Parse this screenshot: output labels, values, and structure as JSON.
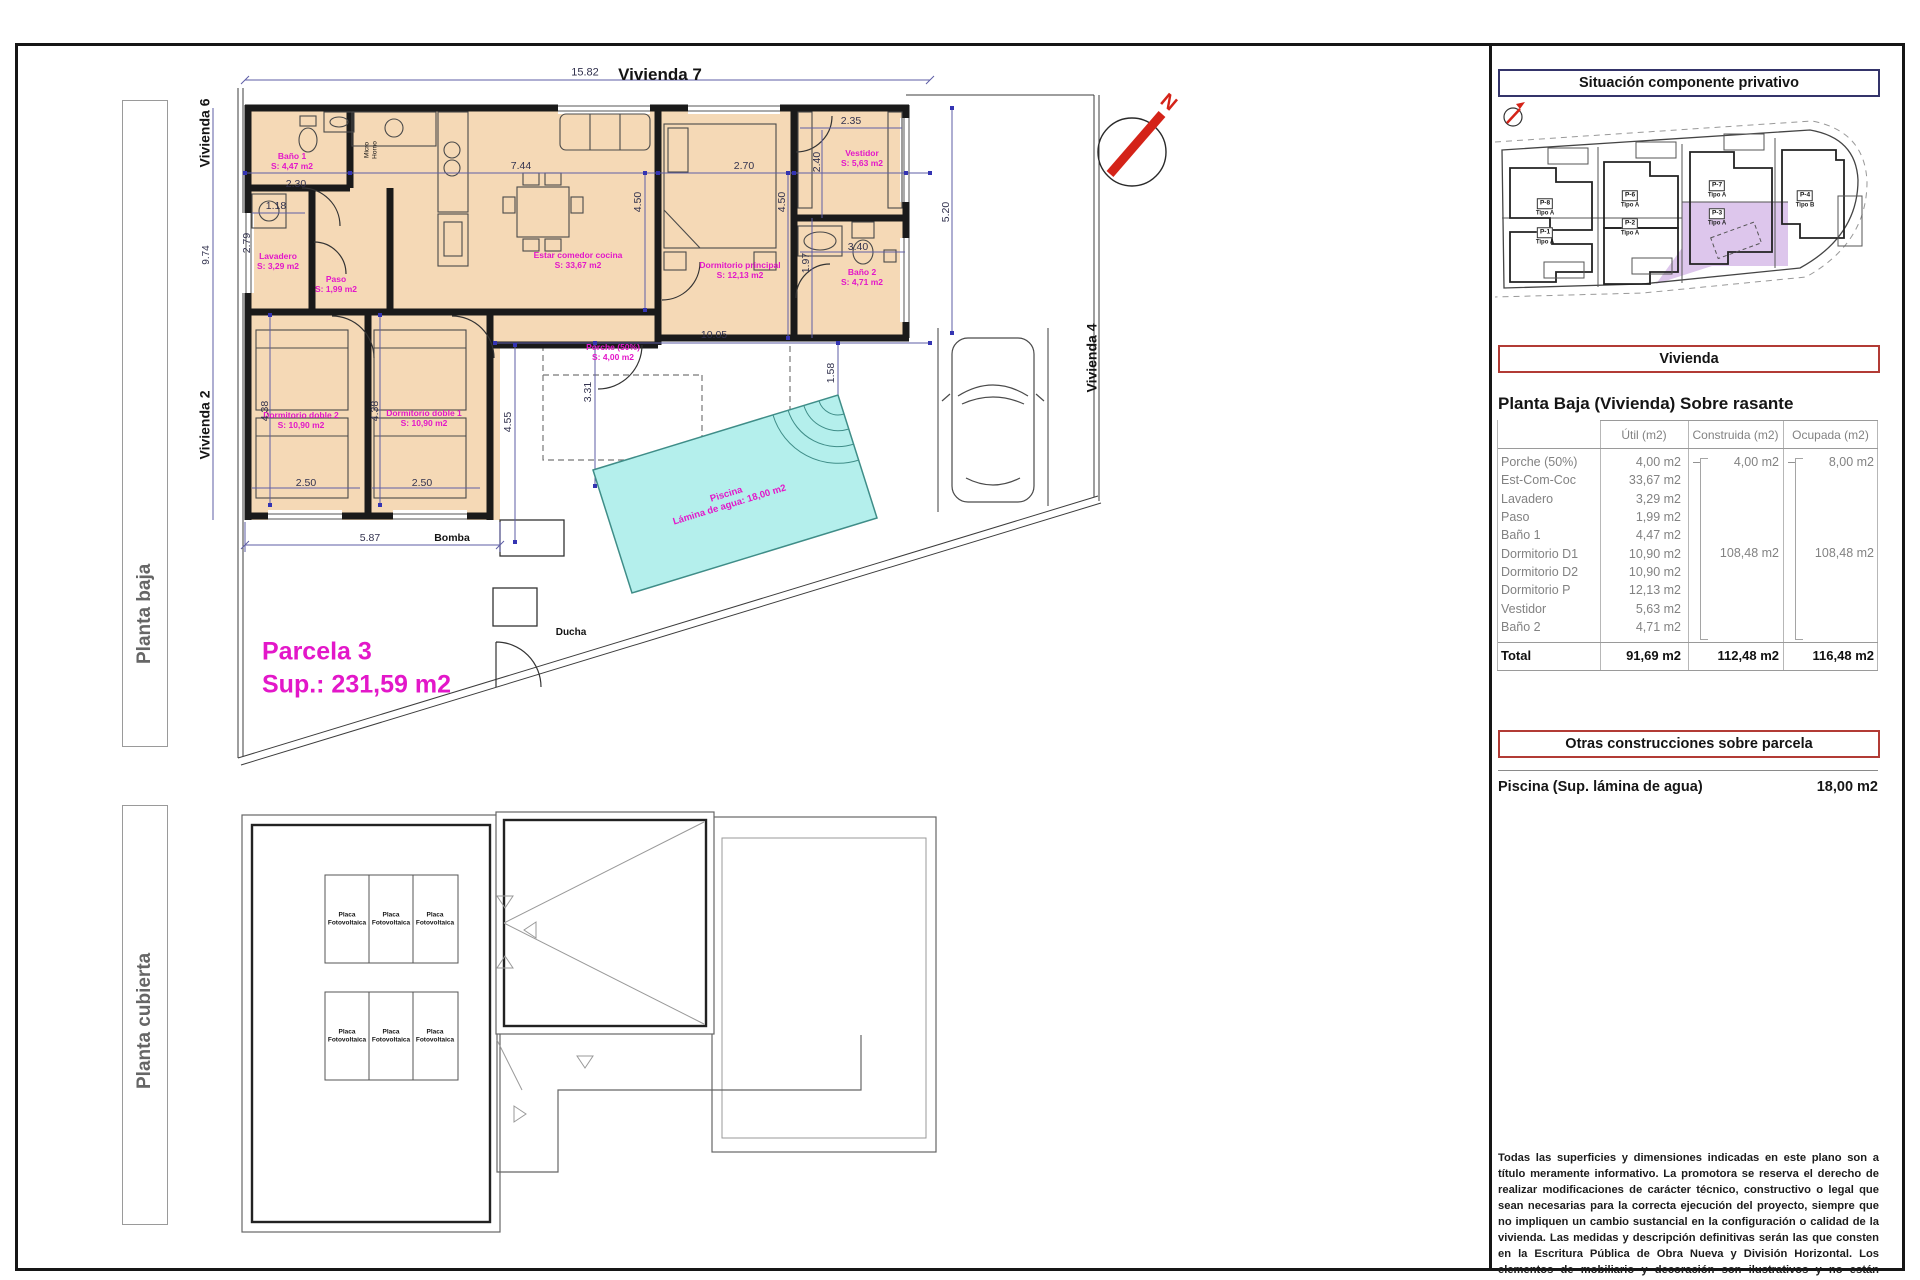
{
  "colors": {
    "ink": "#141414",
    "magenta": "#e317c9",
    "dim": "#32324e",
    "red": "#d42318",
    "gray": "#828282",
    "wall": "#1a1a1a",
    "floor_fill": "#f5d9b6",
    "pool_fill": "#b4efec",
    "lavender": "#ddc6ec",
    "accent_red_border": "#b23b35",
    "accent_navy_border": "#34346a"
  },
  "side_labels": {
    "planta_baja": "Planta baja",
    "planta_cubierta": "Planta cubierta"
  },
  "floor_plan": {
    "labels": [
      {
        "t": "15.82",
        "x": 585,
        "y": 73,
        "s": 11,
        "c": "dim"
      },
      {
        "t": "Vivienda 7",
        "x": 660,
        "y": 75,
        "s": 17,
        "c": "ink",
        "b": 1
      },
      {
        "t": "Vivienda 6",
        "x": 205,
        "y": 133,
        "s": 14,
        "c": "ink",
        "b": 1,
        "r": -90
      },
      {
        "t": "Vivienda 2",
        "x": 205,
        "y": 425,
        "s": 14,
        "c": "ink",
        "b": 1,
        "r": -90
      },
      {
        "t": "Vivienda 4",
        "x": 1092,
        "y": 358,
        "s": 14,
        "c": "ink",
        "b": 1,
        "r": -90
      },
      {
        "t": "9.74",
        "x": 207,
        "y": 255,
        "s": 10,
        "c": "dim",
        "r": -90
      },
      {
        "t": "Baño 1\nS: 4,47 m2",
        "x": 292,
        "y": 161,
        "s": 8.5,
        "c": "magenta",
        "b": 1
      },
      {
        "t": "2.30",
        "x": 296,
        "y": 184,
        "s": 10.5,
        "c": "dim"
      },
      {
        "t": "1.18",
        "x": 276,
        "y": 206,
        "s": 10.5,
        "c": "dim"
      },
      {
        "t": "2.79",
        "x": 247,
        "y": 243,
        "s": 10.5,
        "c": "dim",
        "r": -90
      },
      {
        "t": "Lavadero\nS: 3,29 m2",
        "x": 278,
        "y": 261,
        "s": 8.5,
        "c": "magenta",
        "b": 1
      },
      {
        "t": "Paso\nS: 1,99 m2",
        "x": 336,
        "y": 284,
        "s": 8.5,
        "c": "magenta",
        "b": 1
      },
      {
        "t": "Micro\nHorno",
        "x": 371,
        "y": 150,
        "s": 6.5,
        "c": "ink",
        "r": -90
      },
      {
        "t": "7.44",
        "x": 521,
        "y": 166,
        "s": 10.5,
        "c": "dim"
      },
      {
        "t": "4.50",
        "x": 638,
        "y": 202,
        "s": 10.5,
        "c": "dim",
        "r": -90
      },
      {
        "t": "Estar comedor cocina\nS: 33,67 m2",
        "x": 578,
        "y": 260,
        "s": 8.5,
        "c": "magenta",
        "b": 1
      },
      {
        "t": "2.70",
        "x": 744,
        "y": 166,
        "s": 10.5,
        "c": "dim"
      },
      {
        "t": "4.50",
        "x": 782,
        "y": 202,
        "s": 10.5,
        "c": "dim",
        "r": -90
      },
      {
        "t": "Dormitorio principal\nS: 12,13 m2",
        "x": 740,
        "y": 270,
        "s": 8.5,
        "c": "magenta",
        "b": 1
      },
      {
        "t": "2.35",
        "x": 851,
        "y": 121,
        "s": 10.5,
        "c": "dim"
      },
      {
        "t": "2.40",
        "x": 817,
        "y": 162,
        "s": 10.5,
        "c": "dim",
        "r": -90
      },
      {
        "t": "Vestidor\nS: 5,63 m2",
        "x": 862,
        "y": 158,
        "s": 8.5,
        "c": "magenta",
        "b": 1
      },
      {
        "t": "3.40",
        "x": 858,
        "y": 247,
        "s": 10.5,
        "c": "dim"
      },
      {
        "t": "1.97",
        "x": 806,
        "y": 263,
        "s": 10.5,
        "c": "dim",
        "r": -90
      },
      {
        "t": "Baño 2\nS: 4,71 m2",
        "x": 862,
        "y": 277,
        "s": 8.5,
        "c": "magenta",
        "b": 1
      },
      {
        "t": "5.20",
        "x": 946,
        "y": 212,
        "s": 10.5,
        "c": "dim",
        "r": -90
      },
      {
        "t": "10.05",
        "x": 714,
        "y": 335,
        "s": 10.5,
        "c": "dim"
      },
      {
        "t": "1.58",
        "x": 831,
        "y": 373,
        "s": 10.5,
        "c": "dim",
        "r": -90
      },
      {
        "t": "Porche (50%)\nS: 4,00 m2",
        "x": 613,
        "y": 352,
        "s": 8.5,
        "c": "magenta",
        "b": 1
      },
      {
        "t": "4.55",
        "x": 508,
        "y": 422,
        "s": 10.5,
        "c": "dim",
        "r": -90
      },
      {
        "t": "3.31",
        "x": 588,
        "y": 392,
        "s": 10.5,
        "c": "dim",
        "r": -90
      },
      {
        "t": "Dormitorio doble 2\nS: 10,90 m2",
        "x": 301,
        "y": 420,
        "s": 8.5,
        "c": "magenta",
        "b": 1
      },
      {
        "t": "Dormitorio doble 1\nS: 10,90 m2",
        "x": 424,
        "y": 418,
        "s": 8.5,
        "c": "magenta",
        "b": 1
      },
      {
        "t": "4.38",
        "x": 265,
        "y": 411,
        "s": 10.5,
        "c": "dim",
        "r": -90
      },
      {
        "t": "4.38",
        "x": 375,
        "y": 411,
        "s": 10.5,
        "c": "dim",
        "r": -90
      },
      {
        "t": "2.50",
        "x": 306,
        "y": 483,
        "s": 10.5,
        "c": "dim"
      },
      {
        "t": "2.50",
        "x": 422,
        "y": 483,
        "s": 10.5,
        "c": "dim"
      },
      {
        "t": "5.87",
        "x": 370,
        "y": 538,
        "s": 10.5,
        "c": "dim"
      },
      {
        "t": "Bomba",
        "x": 452,
        "y": 538,
        "s": 10.5,
        "c": "ink",
        "b": 1
      },
      {
        "t": "Ducha",
        "x": 571,
        "y": 633,
        "s": 10,
        "c": "ink",
        "b": 1
      },
      {
        "t": "Parcela 3",
        "x": 262,
        "y": 652,
        "s": 25,
        "c": "magenta",
        "b": 1,
        "a": "l"
      },
      {
        "t": "Sup.: 231,59 m2",
        "x": 262,
        "y": 685,
        "s": 25,
        "c": "magenta",
        "b": 1,
        "a": "l"
      },
      {
        "t": "Piscina\nLámina de agua: 18,00 m2",
        "x": 728,
        "y": 500,
        "s": 9.5,
        "c": "magenta",
        "b": 1,
        "r": -17
      },
      {
        "t": "N",
        "x": 1168,
        "y": 103,
        "s": 20,
        "c": "red",
        "b": 1,
        "r": 40
      }
    ]
  },
  "roof_plan": {
    "panel_label": "Placa\nFotovoltaica",
    "panels": [
      {
        "x": 347,
        "y": 919
      },
      {
        "x": 391,
        "y": 919
      },
      {
        "x": 435,
        "y": 919
      },
      {
        "x": 347,
        "y": 1036
      },
      {
        "x": 391,
        "y": 1036
      },
      {
        "x": 435,
        "y": 1036
      }
    ]
  },
  "site": {
    "title": "Situación componente privativo",
    "plots": [
      {
        "id": "P-8",
        "tipo": "Tipo A",
        "x": 1545,
        "y": 204
      },
      {
        "id": "P-1",
        "tipo": "Tipo A",
        "x": 1545,
        "y": 233
      },
      {
        "id": "P-6",
        "tipo": "Tipo A",
        "x": 1630,
        "y": 196
      },
      {
        "id": "P-2",
        "tipo": "Tipo A",
        "x": 1630,
        "y": 224
      },
      {
        "id": "P-7",
        "tipo": "Tipo A",
        "x": 1717,
        "y": 186
      },
      {
        "id": "P-3",
        "tipo": "Tipo A",
        "x": 1717,
        "y": 214
      },
      {
        "id": "P-4",
        "tipo": "Tipo B",
        "x": 1805,
        "y": 196
      }
    ]
  },
  "vivienda_box": "Vivienda",
  "table": {
    "title": "Planta Baja (Vivienda) Sobre rasante",
    "headers": [
      "Útil (m2)",
      "Construida (m2)",
      "Ocupada (m2)"
    ],
    "rows": [
      {
        "label": "Porche (50%)",
        "util": "4,00 m2",
        "c_dash": "–",
        "c": "4,00 m2",
        "o_dash": "–",
        "o": "8,00 m2"
      },
      {
        "label": "Est-Com-Coc",
        "util": "33,67 m2"
      },
      {
        "label": "Lavadero",
        "util": "3,29 m2"
      },
      {
        "label": "Paso",
        "util": "1,99 m2"
      },
      {
        "label": "Baño 1",
        "util": "4,47 m2"
      },
      {
        "label": "Dormitorio D1",
        "util": "10,90 m2"
      },
      {
        "label": "Dormitorio D2",
        "util": "10,90 m2"
      },
      {
        "label": "Dormitorio P",
        "util": "12,13 m2"
      },
      {
        "label": "Vestidor",
        "util": "5,63 m2"
      },
      {
        "label": "Baño 2",
        "util": "4,71 m2"
      }
    ],
    "construida_group": "108,48 m2",
    "ocupada_group": "108,48 m2",
    "total": {
      "label": "Total",
      "util": "91,69 m2",
      "construida": "112,48 m2",
      "ocupada": "116,48 m2"
    }
  },
  "otras": {
    "title": "Otras construcciones sobre parcela",
    "piscina_label": "Piscina (Sup. lámina de agua)",
    "piscina_value": "18,00 m2"
  },
  "disclaimer": "Todas las superficies y dimensiones indicadas en este plano son a título meramente informativo. La promotora se reserva el derecho de realizar modificaciones de carácter técnico, constructivo o legal que sean necesarias para la correcta ejecución del proyecto, siempre que no impliquen un cambio sustancial en la configuración o calidad de la vivienda. Las medidas y descripción definitivas serán las que consten en la Escritura Pública de Obra Nueva y División Horizontal. Los elementos de mobiliario y decoración son ilustrativos y no están incluidos."
}
